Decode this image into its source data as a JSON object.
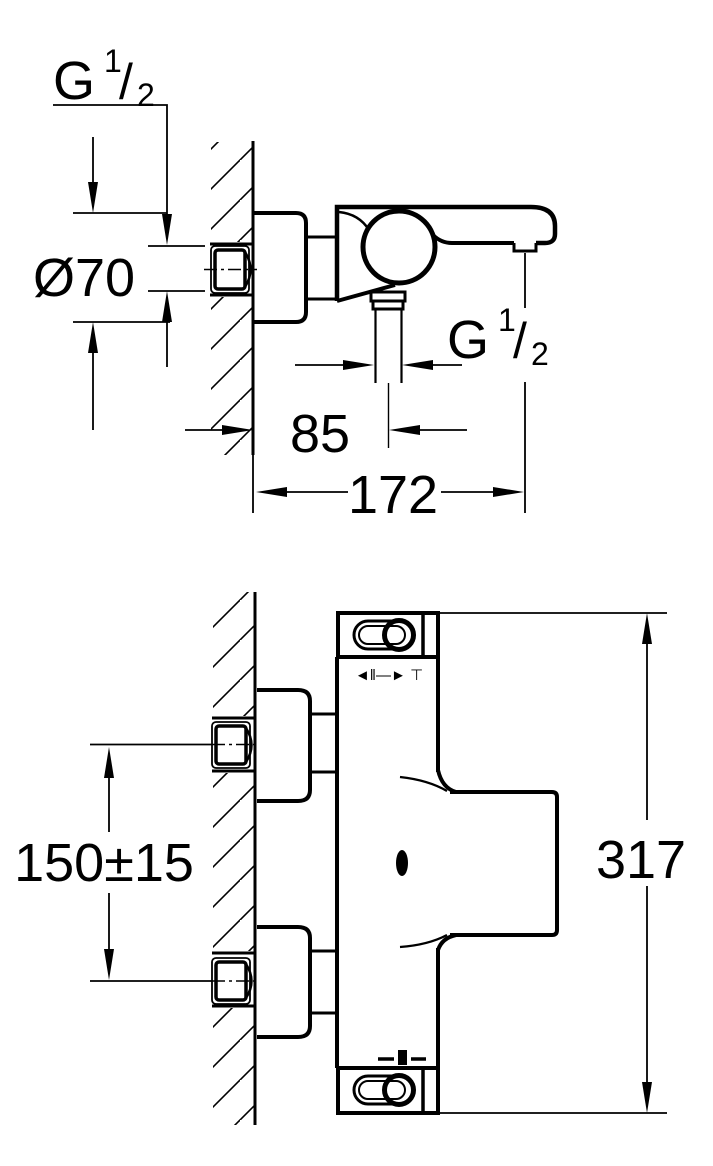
{
  "document": {
    "type": "technical-dimension-drawing",
    "colors": {
      "line": "#000000",
      "background": "#ffffff"
    }
  },
  "labels": {
    "wall_thread": {
      "g": "G",
      "num": "1",
      "slash": "/",
      "den": "2"
    },
    "outlet_thread": {
      "g": "G",
      "num": "1",
      "slash": "/",
      "den": "2"
    },
    "escutcheon_diameter": "Ø70",
    "outlet_offset": "85",
    "spout_reach": "172",
    "inlet_spacing": "150±15",
    "total_height": "317"
  },
  "icons": {
    "diverter_markings": "◄‖—► ⊤"
  }
}
